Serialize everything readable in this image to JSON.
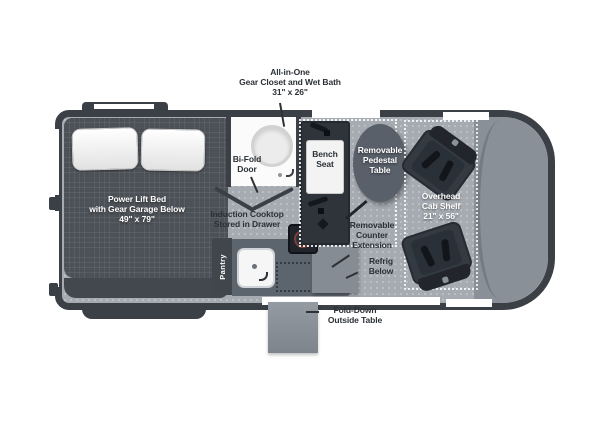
{
  "plan": {
    "labels": {
      "gear_closet": {
        "l1": "All-in-One",
        "l2": "Gear Closet and Wet Bath",
        "l3": "31\" x 26\""
      },
      "bed": {
        "l1": "Power Lift Bed",
        "l2": "with Gear Garage Below",
        "l3": "49\" x 79\""
      },
      "bifold": {
        "l1": "Bi-Fold",
        "l2": "Door"
      },
      "bench": {
        "l1": "Bench",
        "l2": "Seat"
      },
      "pedestal": {
        "l1": "Removable",
        "l2": "Pedestal",
        "l3": "Table"
      },
      "cab_shelf": {
        "l1": "Overhead",
        "l2": "Cab Shelf",
        "l3": "21\" x 56\""
      },
      "cooktop": {
        "l1": "Induction Cooktop",
        "l2": "Stored in Drawer"
      },
      "counter_ext": {
        "l1": "Removable",
        "l2": "Counter",
        "l3": "Extension"
      },
      "refrig": {
        "l1": "Refrig",
        "l2": "Below"
      },
      "pantry": "Pantry",
      "outside_table": {
        "l1": "Fold-Down",
        "l2": "Outside Table"
      }
    },
    "colors": {
      "body_outline": "#3b4046",
      "floor": "#a6abb2",
      "bed": "#4c5157",
      "cushion_white": "#f3f3f3",
      "pedestal_table": "#59606a",
      "counter": "#5c646e",
      "seat_dark": "#2f343b",
      "label_dark": "#2c3136",
      "label_light": "#ffffff"
    }
  }
}
